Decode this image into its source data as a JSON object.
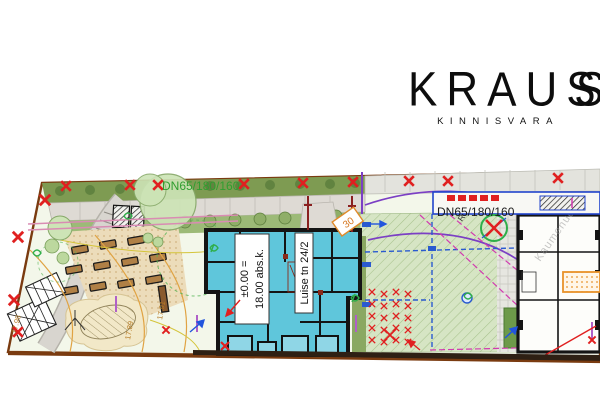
{
  "logo": {
    "letters_main": "KRAU",
    "s1": "S",
    "s2": "S",
    "subtitle": "KINNISVARA"
  },
  "plan": {
    "pipe_label_top": "DN65/180/160",
    "pipe_label_right": "DN65/180/160",
    "radius_label": "R6.0",
    "survey_box": "30",
    "building": {
      "level_top": "±0.00 =",
      "level_bottom": "18.00 abs.k.",
      "address": "Luise tn 24/2"
    },
    "contours": {
      "left": "17.98",
      "middle": "17.89",
      "right": "17.91"
    },
    "watermark": "Kaumenud"
  },
  "colors": {
    "building_fill": "#5fc6db",
    "boundary_brown": "#7a3b10",
    "mark_red": "#e02020",
    "pipe_green": "#2f9e2f",
    "utility_blue": "#2a5ad0",
    "road_purple": "#7b3fc4",
    "survey_orange": "#e08a2a",
    "magenta": "#d23bb0"
  }
}
